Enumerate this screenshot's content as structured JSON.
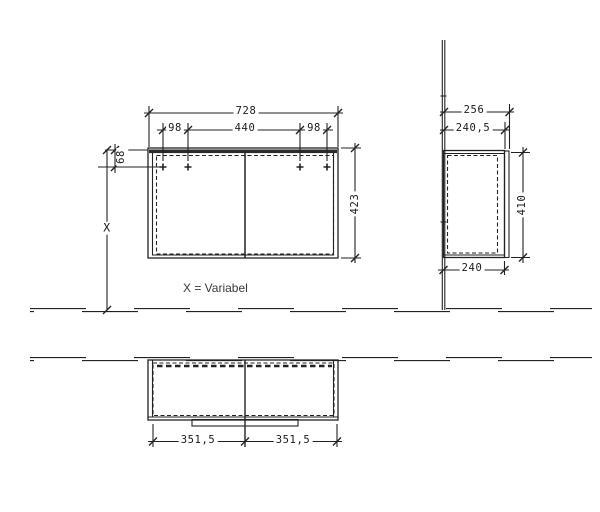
{
  "drawing": {
    "note": {
      "text": "X = Variabel"
    },
    "front_view": {
      "width_total": "728",
      "offset_left": "98",
      "span_center": "440",
      "offset_right": "98",
      "height": "423",
      "mount_offset": "68",
      "height_variable": "X"
    },
    "side_view": {
      "depth_total": "256",
      "depth_front": "240,5",
      "door_height": "410",
      "body_depth": "240"
    },
    "bottom_view": {
      "door_width_left": "351,5",
      "door_width_right": "351,5"
    },
    "colors": {
      "line": "#222222",
      "background": "#ffffff"
    }
  }
}
